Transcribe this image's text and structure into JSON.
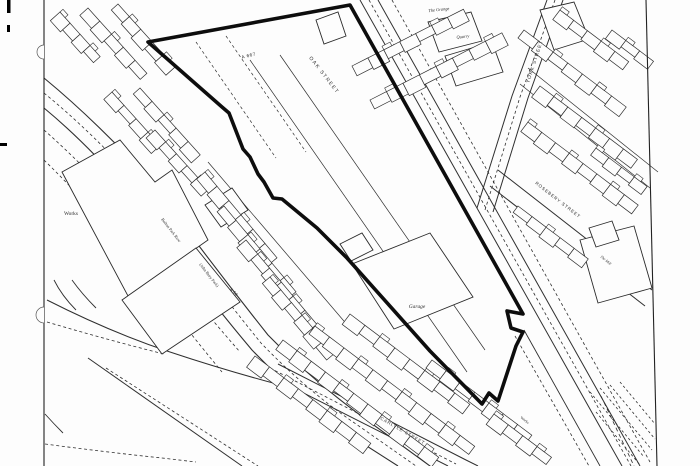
{
  "meta": {
    "type": "scanned-site-plan-map",
    "bg": "#fdfdfd",
    "ink": "#2f2f2f",
    "site_outline_color": "#0d0d0d",
    "width": 700,
    "height": 466
  },
  "labels": [
    {
      "id": "a667",
      "text": "A 667",
      "x": 249,
      "y": 57,
      "rot": -14,
      "size": 4.6,
      "font": "sans",
      "ls": 0.6
    },
    {
      "id": "oak-street",
      "text": "OAK  STREET",
      "x": 323,
      "y": 76,
      "rot": 52,
      "size": 5,
      "font": "sans",
      "ls": 1.4
    },
    {
      "id": "york-street",
      "text": "YORK STREET",
      "x": 536,
      "y": 62,
      "rot": -72,
      "size": 4.8,
      "font": "sans",
      "ls": 1
    },
    {
      "id": "rosebery-street",
      "text": "ROSEBERY STREET",
      "x": 557,
      "y": 201,
      "rot": 38,
      "size": 4.4,
      "font": "sans",
      "ls": 0.9
    },
    {
      "id": "the-grange",
      "text": "The Grange",
      "x": 439,
      "y": 11,
      "rot": -6,
      "size": 4.4,
      "font": "serif",
      "italic": true
    },
    {
      "id": "quarry",
      "text": "Quarry",
      "x": 463,
      "y": 38,
      "rot": -6,
      "size": 4.4,
      "font": "serif",
      "italic": true
    },
    {
      "id": "works",
      "text": "Works",
      "x": 71,
      "y": 215,
      "rot": 0,
      "size": 5.4,
      "font": "serif"
    },
    {
      "id": "garage",
      "text": "Garage",
      "x": 417,
      "y": 308,
      "rot": 0,
      "size": 5.4,
      "font": "serif",
      "italic": true
    },
    {
      "id": "park-row",
      "text": "Bolton Park Row",
      "x": 170,
      "y": 231,
      "rot": 52,
      "size": 4.2,
      "font": "serif"
    },
    {
      "id": "bury-park",
      "text": "(John Bury Park)",
      "x": 208,
      "y": 276,
      "rot": 52,
      "size": 4.2,
      "font": "serif"
    },
    {
      "id": "a58",
      "text": "A 58",
      "x": 233,
      "y": 293,
      "rot": 45,
      "size": 4,
      "font": "sans",
      "ls": 0.4
    },
    {
      "id": "carlyle-street",
      "text": "CARLYLE STREET",
      "x": 402,
      "y": 432,
      "rot": 30,
      "size": 4.4,
      "font": "sans",
      "ls": 0.9
    },
    {
      "id": "the-mill",
      "text": "The Mill",
      "x": 605,
      "y": 261,
      "rot": 40,
      "size": 3.8,
      "font": "serif",
      "italic": true
    },
    {
      "id": "works-small",
      "text": "Works",
      "x": 524,
      "y": 421,
      "rot": 38,
      "size": 3.8,
      "font": "serif"
    }
  ],
  "site_outline": {
    "stroke_width": 3.6,
    "points": [
      [
        148,
        42
      ],
      [
        350,
        5
      ],
      [
        523,
        314
      ],
      [
        507,
        311
      ],
      [
        511,
        328
      ],
      [
        523,
        332
      ],
      [
        516,
        346
      ],
      [
        498,
        401
      ],
      [
        489,
        393
      ],
      [
        482,
        404
      ],
      [
        430,
        351
      ],
      [
        347,
        258
      ],
      [
        317,
        228
      ],
      [
        282,
        199
      ],
      [
        273,
        198
      ],
      [
        264,
        182
      ],
      [
        258,
        174
      ],
      [
        250,
        157
      ],
      [
        243,
        149
      ],
      [
        229,
        113
      ],
      [
        222,
        107
      ],
      [
        148,
        42
      ]
    ]
  },
  "roads": [
    {
      "id": "rail-1",
      "d": "M360,0 L622,466",
      "w": 1
    },
    {
      "id": "rail-2",
      "d": "M378,0 L640,466",
      "w": 1
    },
    {
      "id": "rail-dash-1",
      "d": "M369,0 L631,466",
      "w": 0.8,
      "dash": true
    },
    {
      "id": "rail-dash-2",
      "d": "M392,0 L650,462",
      "w": 0.8,
      "dash": true
    },
    {
      "id": "rail-left-lower",
      "d": "M524,330 L600,466",
      "w": 0.9
    },
    {
      "id": "rail-left-lower-dash",
      "d": "M515,336 L589,466",
      "w": 0.8,
      "dash": true
    },
    {
      "id": "york-edge-1",
      "d": "M547,0 L512,96 L477,208",
      "w": 1
    },
    {
      "id": "york-edge-2",
      "d": "M563,0 L528,98 L493,212",
      "w": 1
    },
    {
      "id": "york-dash",
      "d": "M555,0 L520,97 L485,210",
      "w": 0.8,
      "dash": true
    },
    {
      "id": "rosebery-edge-1",
      "d": "M498,170 L652,290",
      "w": 1
    },
    {
      "id": "rosebery-edge-2",
      "d": "M490,186 L645,306",
      "w": 1
    },
    {
      "id": "tr-back-lane-1",
      "d": "M528,68 L658,172",
      "w": 0.7
    },
    {
      "id": "tr-back-lane-2",
      "d": "M520,84 L650,188",
      "w": 0.7
    },
    {
      "id": "park-row-edge-1",
      "d": "M44,78 Q95,120 150,180 Q210,262 268,335 Q310,378 360,415 L430,466",
      "w": 1.1
    },
    {
      "id": "park-row-edge-2",
      "d": "M44,108 Q90,146 140,205 Q198,286 252,350 Q300,400 348,434 L398,466",
      "w": 1.1
    },
    {
      "id": "park-row-dash",
      "d": "M44,93 Q93,133 146,192 Q205,274 261,343 Q306,390 356,424 L416,466",
      "w": 0.8,
      "dash": true
    },
    {
      "id": "park-dash-west-1",
      "d": "M44,130 Q95,175 140,230 Q190,295 240,352",
      "w": 0.8,
      "dash": true
    },
    {
      "id": "park-dash-west-2",
      "d": "M44,160 Q90,205 130,255 Q175,315 222,372",
      "w": 0.8,
      "dash": true
    },
    {
      "id": "bl-curve",
      "d": "M47,300 Q110,332 170,352 Q230,372 292,388",
      "w": 1
    },
    {
      "id": "bl-curve-dash",
      "d": "M47,322 Q108,340 164,354",
      "w": 0.8,
      "dash": true
    },
    {
      "id": "bl-straight",
      "d": "M88,358 L242,466",
      "w": 1
    },
    {
      "id": "bl-straight-dash",
      "d": "M106,368 L258,466",
      "w": 0.8,
      "dash": true
    },
    {
      "id": "bl-fork-1",
      "d": "M54,280 Q62,296 76,310",
      "w": 0.9
    },
    {
      "id": "bl-fork-2",
      "d": "M72,280 Q82,294 96,308",
      "w": 0.9
    },
    {
      "id": "bl-bottom-dash",
      "d": "M45,444 Q105,452 162,458 L196,462",
      "w": 0.8,
      "dash": true
    },
    {
      "id": "bl-bottom-solid",
      "d": "M45,414 Q54,424 63,433",
      "w": 0.9
    },
    {
      "id": "site-inner-1",
      "d": "M250,60 L467,372",
      "w": 0.7
    },
    {
      "id": "site-inner-2",
      "d": "M280,55 L485,350",
      "w": 0.7
    },
    {
      "id": "site-inner-dash-1",
      "d": "M196,42 L276,158",
      "w": 0.7,
      "dash": true
    },
    {
      "id": "site-inner-dash-2",
      "d": "M226,36 L306,152",
      "w": 0.7,
      "dash": true
    },
    {
      "id": "ml-back-lane",
      "d": "M208,162 L355,334",
      "w": 0.7
    },
    {
      "id": "carlyle-edge-1",
      "d": "M262,372 L448,466",
      "w": 1
    },
    {
      "id": "carlyle-edge-2",
      "d": "M278,364 L466,460 L478,466",
      "w": 1
    },
    {
      "id": "carlyle-dash",
      "d": "M270,368 L456,464",
      "w": 0.8,
      "dash": true
    }
  ],
  "buildings": [
    {
      "id": "works-main",
      "points": [
        [
          62,
          172
        ],
        [
          120,
          140
        ],
        [
          155,
          182
        ],
        [
          172,
          170
        ],
        [
          208,
          240
        ],
        [
          128,
          296
        ]
      ]
    },
    {
      "id": "works-south",
      "points": [
        [
          122,
          300
        ],
        [
          196,
          248
        ],
        [
          240,
          302
        ],
        [
          162,
          354
        ]
      ]
    },
    {
      "id": "works-annex",
      "points": [
        [
          205,
          205
        ],
        [
          232,
          188
        ],
        [
          248,
          210
        ],
        [
          221,
          227
        ]
      ]
    },
    {
      "id": "garage-main",
      "points": [
        [
          352,
          264
        ],
        [
          430,
          233
        ],
        [
          473,
          297
        ],
        [
          394,
          329
        ]
      ]
    },
    {
      "id": "garage-annex",
      "points": [
        [
          340,
          244
        ],
        [
          362,
          233
        ],
        [
          373,
          250
        ],
        [
          351,
          261
        ]
      ]
    },
    {
      "id": "mill",
      "points": [
        [
          580,
          240
        ],
        [
          634,
          226
        ],
        [
          652,
          288
        ],
        [
          598,
          303
        ]
      ]
    },
    {
      "id": "mill-annex",
      "points": [
        [
          589,
          228
        ],
        [
          612,
          221
        ],
        [
          619,
          240
        ],
        [
          596,
          247
        ]
      ]
    },
    {
      "id": "grange-1",
      "points": [
        [
          428,
          22
        ],
        [
          471,
          12
        ],
        [
          482,
          41
        ],
        [
          439,
          52
        ]
      ]
    },
    {
      "id": "grange-2",
      "points": [
        [
          445,
          56
        ],
        [
          492,
          42
        ],
        [
          503,
          72
        ],
        [
          456,
          86
        ]
      ]
    },
    {
      "id": "york-corner",
      "points": [
        [
          540,
          10
        ],
        [
          574,
          2
        ],
        [
          589,
          39
        ],
        [
          554,
          50
        ]
      ]
    },
    {
      "id": "oak-lone",
      "points": [
        [
          316,
          20
        ],
        [
          338,
          12
        ],
        [
          346,
          36
        ],
        [
          324,
          44
        ]
      ]
    }
  ],
  "terraces": [
    {
      "x": 60,
      "y": 12,
      "angle": 48,
      "len": 60,
      "depth": 13,
      "cells": 4
    },
    {
      "x": 88,
      "y": 8,
      "angle": 48,
      "len": 88,
      "depth": 13,
      "cells": 5
    },
    {
      "x": 118,
      "y": 4,
      "angle": 48,
      "len": 85,
      "depth": 13,
      "cells": 5
    },
    {
      "x": 112,
      "y": 92,
      "angle": 48,
      "len": 72,
      "depth": 12,
      "cells": 4
    },
    {
      "x": 140,
      "y": 88,
      "angle": 48,
      "len": 90,
      "depth": 12,
      "cells": 5
    },
    {
      "x": 155,
      "y": 130,
      "angle": 48,
      "len": 80,
      "depth": 12,
      "cells": 5
    },
    {
      "x": 205,
      "y": 172,
      "angle": 50,
      "len": 112,
      "depth": 13,
      "cells": 6
    },
    {
      "x": 224,
      "y": 206,
      "angle": 50,
      "len": 112,
      "depth": 13,
      "cells": 6
    },
    {
      "x": 246,
      "y": 240,
      "angle": 50,
      "len": 110,
      "depth": 13,
      "cells": 6
    },
    {
      "x": 270,
      "y": 277,
      "angle": 50,
      "len": 100,
      "depth": 13,
      "cells": 6
    },
    {
      "x": 255,
      "y": 356,
      "angle": 37,
      "len": 145,
      "depth": 14,
      "cells": 8
    },
    {
      "x": 283,
      "y": 340,
      "angle": 37,
      "len": 195,
      "depth": 14,
      "cells": 11
    },
    {
      "x": 315,
      "y": 326,
      "angle": 37,
      "len": 200,
      "depth": 14,
      "cells": 11
    },
    {
      "x": 350,
      "y": 314,
      "angle": 37,
      "len": 150,
      "depth": 14,
      "cells": 8
    },
    {
      "x": 432,
      "y": 360,
      "angle": 37,
      "len": 125,
      "depth": 13,
      "cells": 7
    },
    {
      "x": 494,
      "y": 414,
      "angle": 37,
      "len": 72,
      "depth": 13,
      "cells": 4
    },
    {
      "x": 352,
      "y": 66,
      "angle": -27,
      "len": 125,
      "depth": 13,
      "cells": 7
    },
    {
      "x": 370,
      "y": 100,
      "angle": -27,
      "len": 148,
      "depth": 14,
      "cells": 8
    },
    {
      "x": 560,
      "y": 10,
      "angle": 37,
      "len": 86,
      "depth": 13,
      "cells": 5
    },
    {
      "x": 524,
      "y": 30,
      "angle": 37,
      "len": 128,
      "depth": 13,
      "cells": 7
    },
    {
      "x": 540,
      "y": 86,
      "angle": 37,
      "len": 122,
      "depth": 14,
      "cells": 7
    },
    {
      "x": 528,
      "y": 122,
      "angle": 37,
      "len": 138,
      "depth": 14,
      "cells": 8
    },
    {
      "x": 518,
      "y": 206,
      "angle": 37,
      "len": 88,
      "depth": 12,
      "cells": 5
    },
    {
      "x": 612,
      "y": 30,
      "angle": 37,
      "len": 52,
      "depth": 12,
      "cells": 3
    },
    {
      "x": 596,
      "y": 148,
      "angle": 37,
      "len": 64,
      "depth": 12,
      "cells": 4
    }
  ],
  "frame": {
    "left_line": "M44,0 L44,466",
    "right_line": "M646,0 L657,466",
    "notches": [
      {
        "cx": 44,
        "cy": 52,
        "r": 7
      },
      {
        "cx": 44,
        "cy": 315,
        "r": 8
      }
    ],
    "ticks": [
      {
        "x": 7,
        "y": 0,
        "w": 3.5,
        "h": 13
      },
      {
        "x": 7,
        "y": 25,
        "w": 3,
        "h": 7
      },
      {
        "x": 0,
        "y": 143,
        "w": 7,
        "h": 3
      }
    ]
  },
  "hatches": {
    "rows": [
      {
        "d": "M590,392 L644,457"
      },
      {
        "d": "M600,388 L652,450"
      },
      {
        "d": "M610,385 L655,439"
      },
      {
        "d": "M620,382 L655,424"
      },
      {
        "d": "M596,412 L640,465"
      }
    ],
    "long_dash": "M601,396 L634,466"
  }
}
